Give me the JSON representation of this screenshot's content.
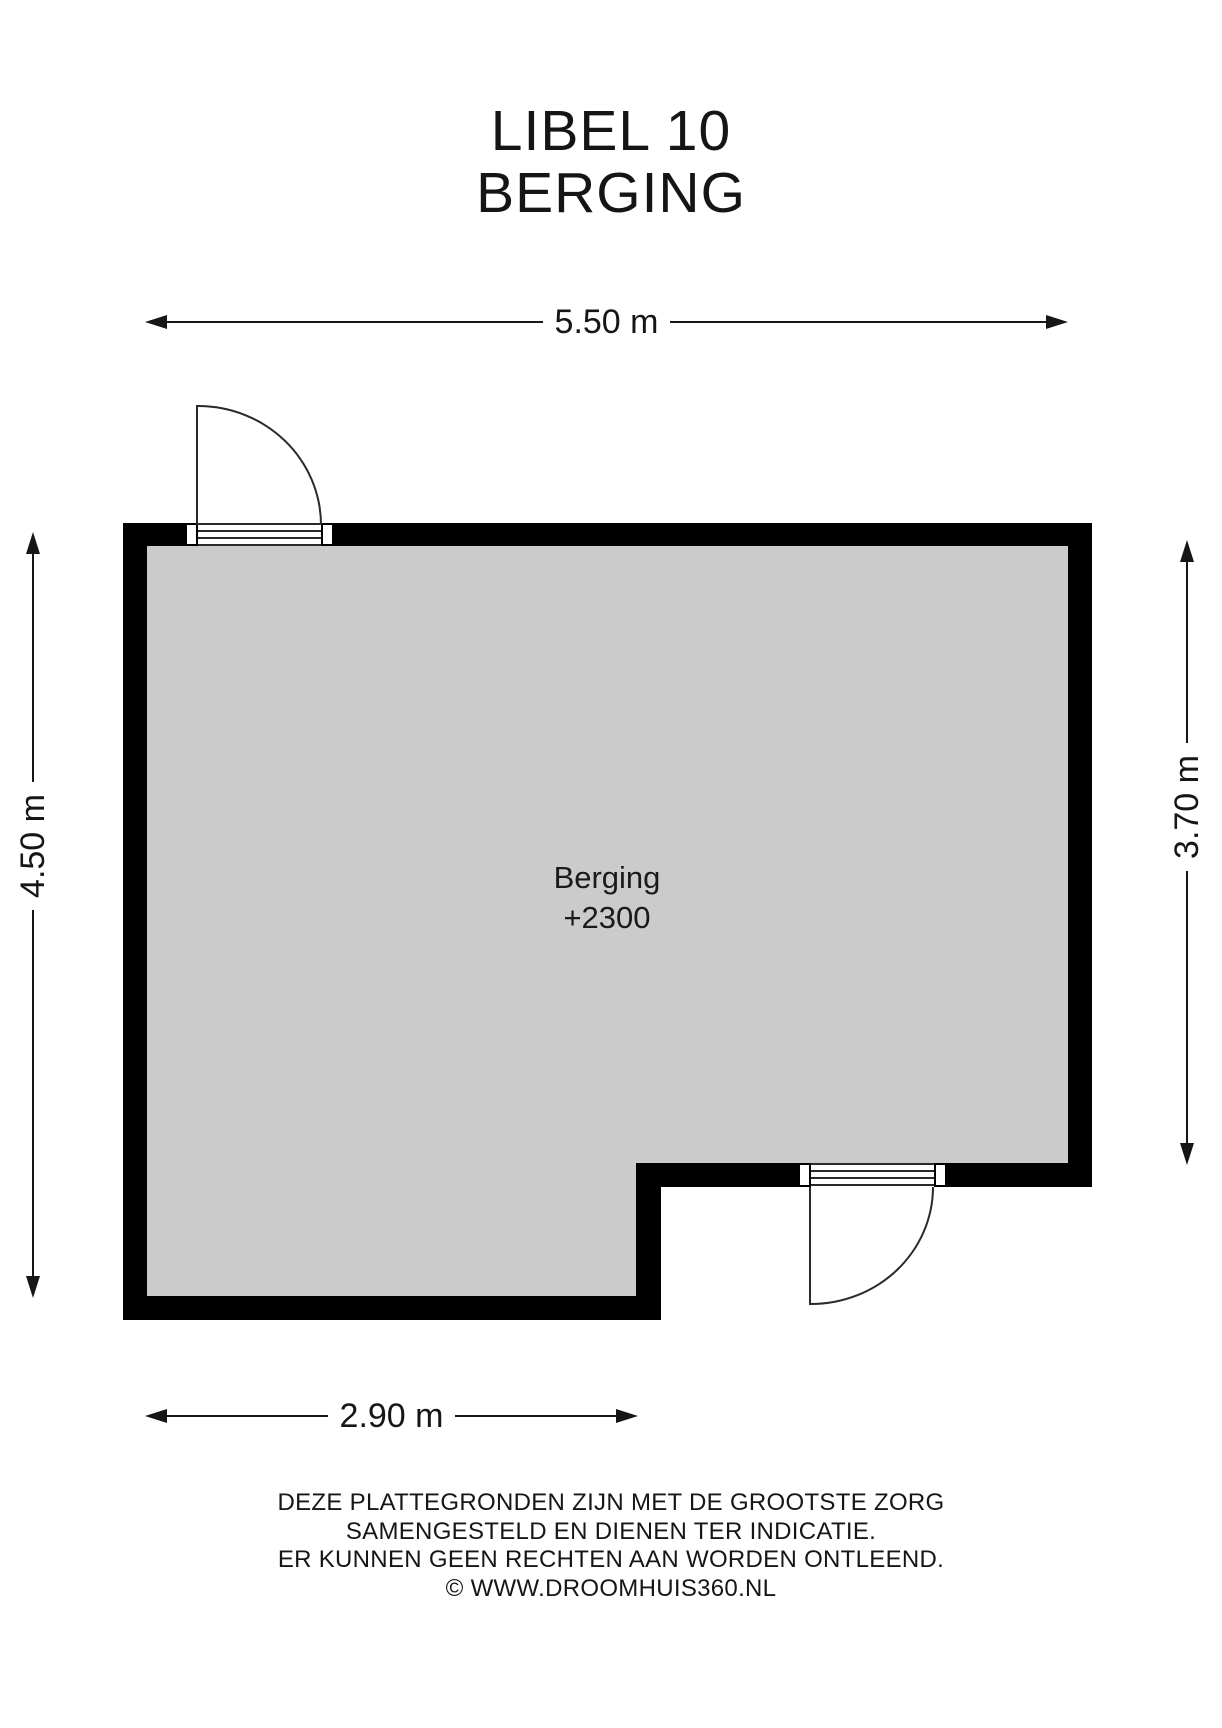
{
  "title": {
    "line1": "LIBEL 10",
    "line2": "BERGING"
  },
  "floorplan": {
    "room_label": "Berging",
    "room_elevation": "+2300"
  },
  "dimensions": {
    "top": "5.50 m",
    "left": "4.50 m",
    "right": "3.70 m",
    "bottom": "2.90 m"
  },
  "footer": {
    "lines": [
      "DEZE PLATTEGRONDEN ZIJN MET DE GROOTSTE ZORG",
      "SAMENGESTELD EN DIENEN TER INDICATIE.",
      "ER KUNNEN GEEN RECHTEN AAN WORDEN ONTLEEND.",
      "© WWW.DROOMHUIS360.NL"
    ]
  },
  "colors": {
    "wall": "#000000",
    "floor": "#cbcbcb",
    "line": "#161616",
    "background": "#ffffff"
  }
}
